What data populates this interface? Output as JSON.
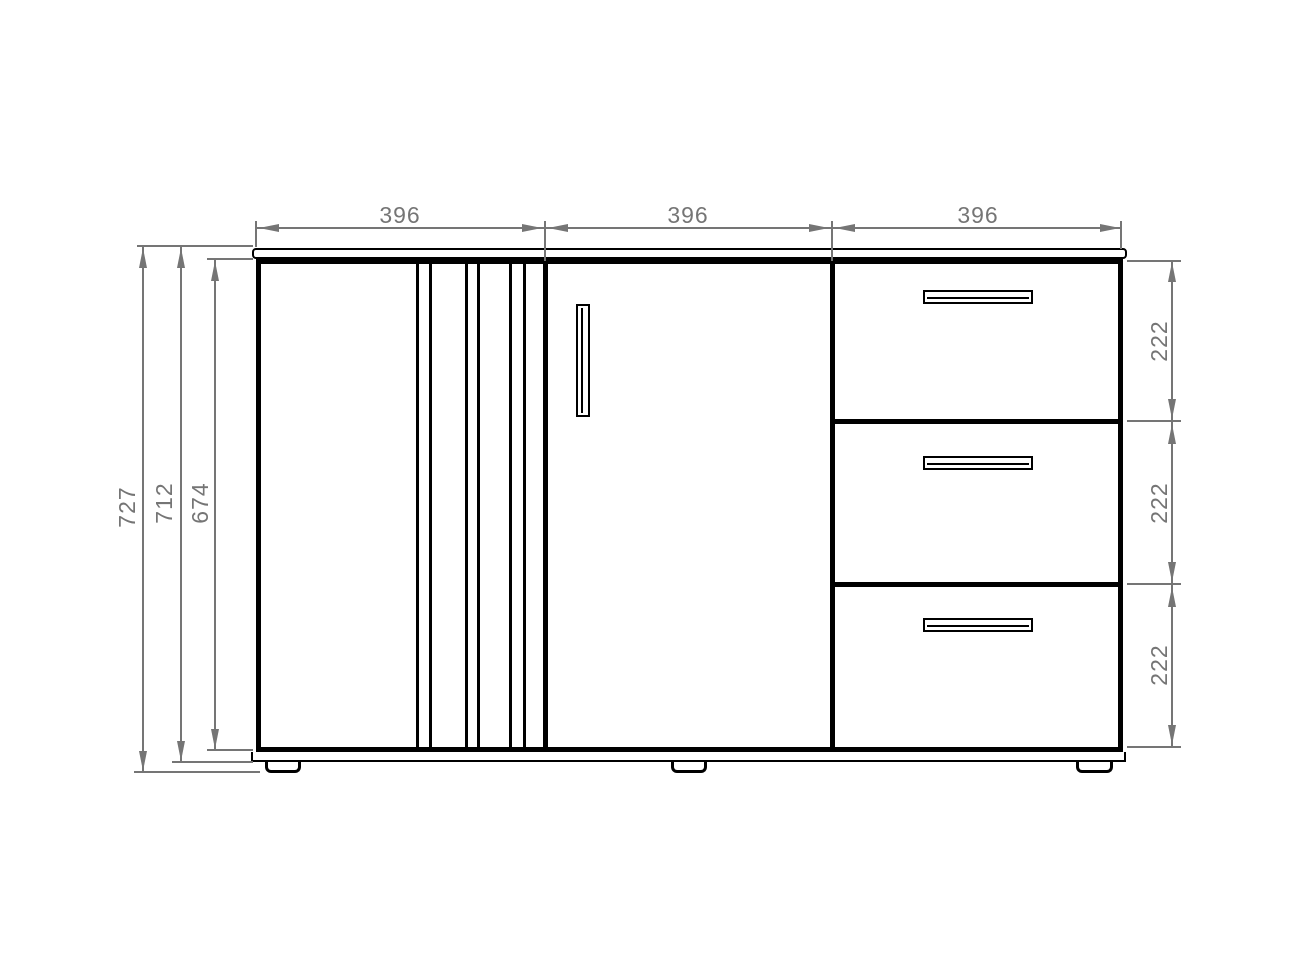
{
  "dimensions": {
    "top_widths": [
      {
        "label": "396"
      },
      {
        "label": "396"
      },
      {
        "label": "396"
      }
    ],
    "left_heights": [
      {
        "label": "727"
      },
      {
        "label": "712"
      },
      {
        "label": "674"
      }
    ],
    "right_drawer_heights": [
      {
        "label": "222"
      },
      {
        "label": "222"
      },
      {
        "label": "222"
      }
    ]
  },
  "colors": {
    "object_line": "#000000",
    "dimension_line": "#757575",
    "background": "#ffffff"
  }
}
